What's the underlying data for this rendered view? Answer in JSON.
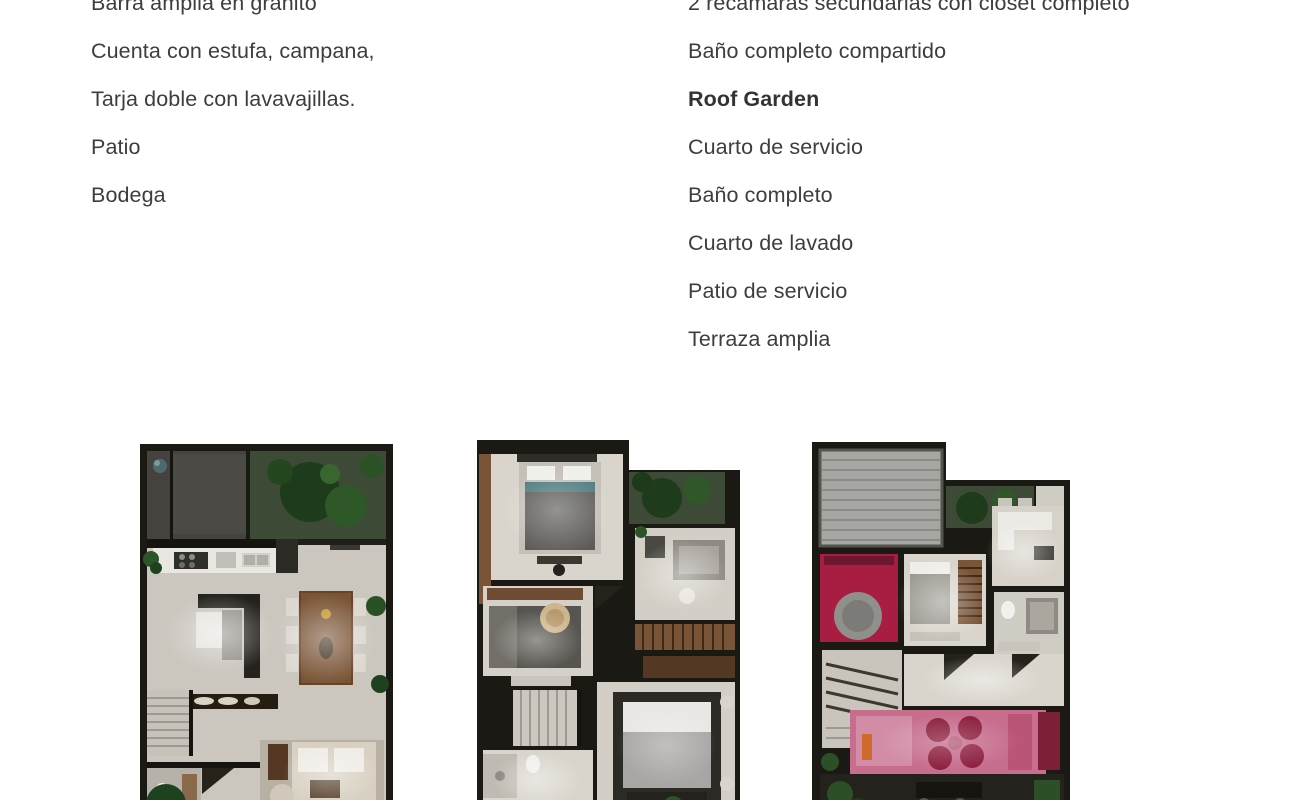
{
  "palette": {
    "text": "#3d3d3d",
    "wall": "#1b1914",
    "floor": "#d9d5cc",
    "floor_dim": "#c0bcb3",
    "garage": "#45433e",
    "garden": "#3d4a36",
    "tree_dark": "#1e3c1c",
    "tree_mid": "#2f5829",
    "wood": "#7a5436",
    "wood_dark": "#553823",
    "counter": "#e9e7e1",
    "furniture_dark": "#2c2a25",
    "bed_gray": "#5d5c58",
    "pergola": "#a6a6a2",
    "accent_red": "#a81e43",
    "terrace_pink": "#c76d8e",
    "chair_crimson": "#8c1f3e",
    "sofa_beige": "#d8d1c3"
  },
  "features": {
    "left": [
      "Barra amplia en granito",
      "Cuenta con estufa, campana,",
      "Tarja doble con lavavajillas.",
      "Patio",
      "Bodega"
    ],
    "right": [
      "2 recámaras secundarias con closet completo",
      "Baño completo compartido",
      "Roof Garden",
      "Cuarto de servicio",
      "Baño completo",
      "Cuarto de lavado",
      "Patio de servicio",
      "Terraza amplia"
    ]
  }
}
